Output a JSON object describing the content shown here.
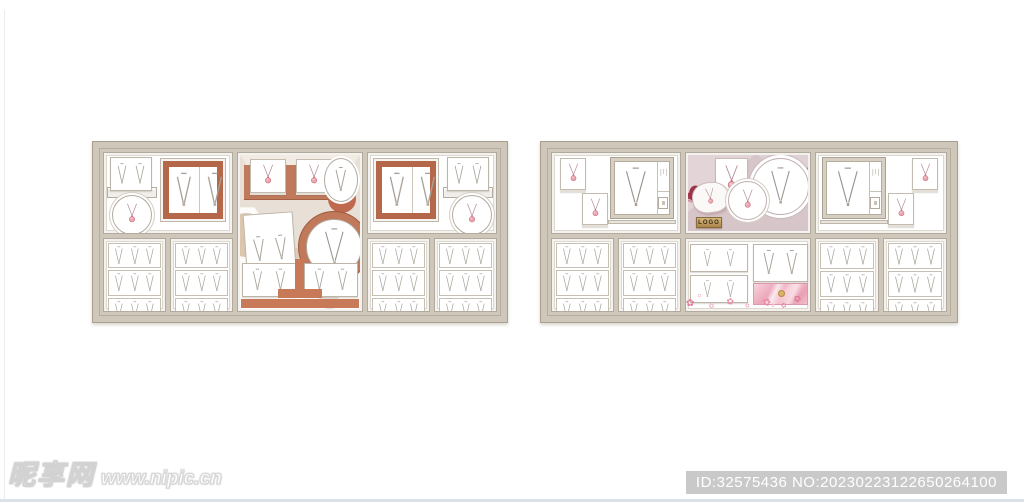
{
  "page": {
    "watermark": {
      "logo": "昵享网",
      "url": "www.nipic.cn"
    },
    "id_badge": "ID:32575436 NO:20230223122650264100"
  },
  "colors": {
    "case_frame": "#cfc8ba",
    "case_frame_line": "#a89f90",
    "left_theme_terracotta": "#c1795b",
    "left_scene_beige": "#e8e0d6",
    "tan_prop": "#dcc6ae",
    "right_scene_mauve": "#d7c6c9",
    "ribbon_red": "#a83a50",
    "gold_plaque": "#c0a05e",
    "pink_fabric": "#eba6ba",
    "pendant_pink": "#eaa4b0",
    "necklace_line_gray": "#a8a29a"
  },
  "necklace_grid": {
    "rows": 3,
    "cols": 3
  },
  "cases": [
    {
      "id": "left-case",
      "theme": "terracotta-beige",
      "grid_compartments": 4
    },
    {
      "id": "right-case",
      "theme": "mauve-pink",
      "grid_compartments": 4,
      "plaque_label": "LOGO"
    }
  ]
}
